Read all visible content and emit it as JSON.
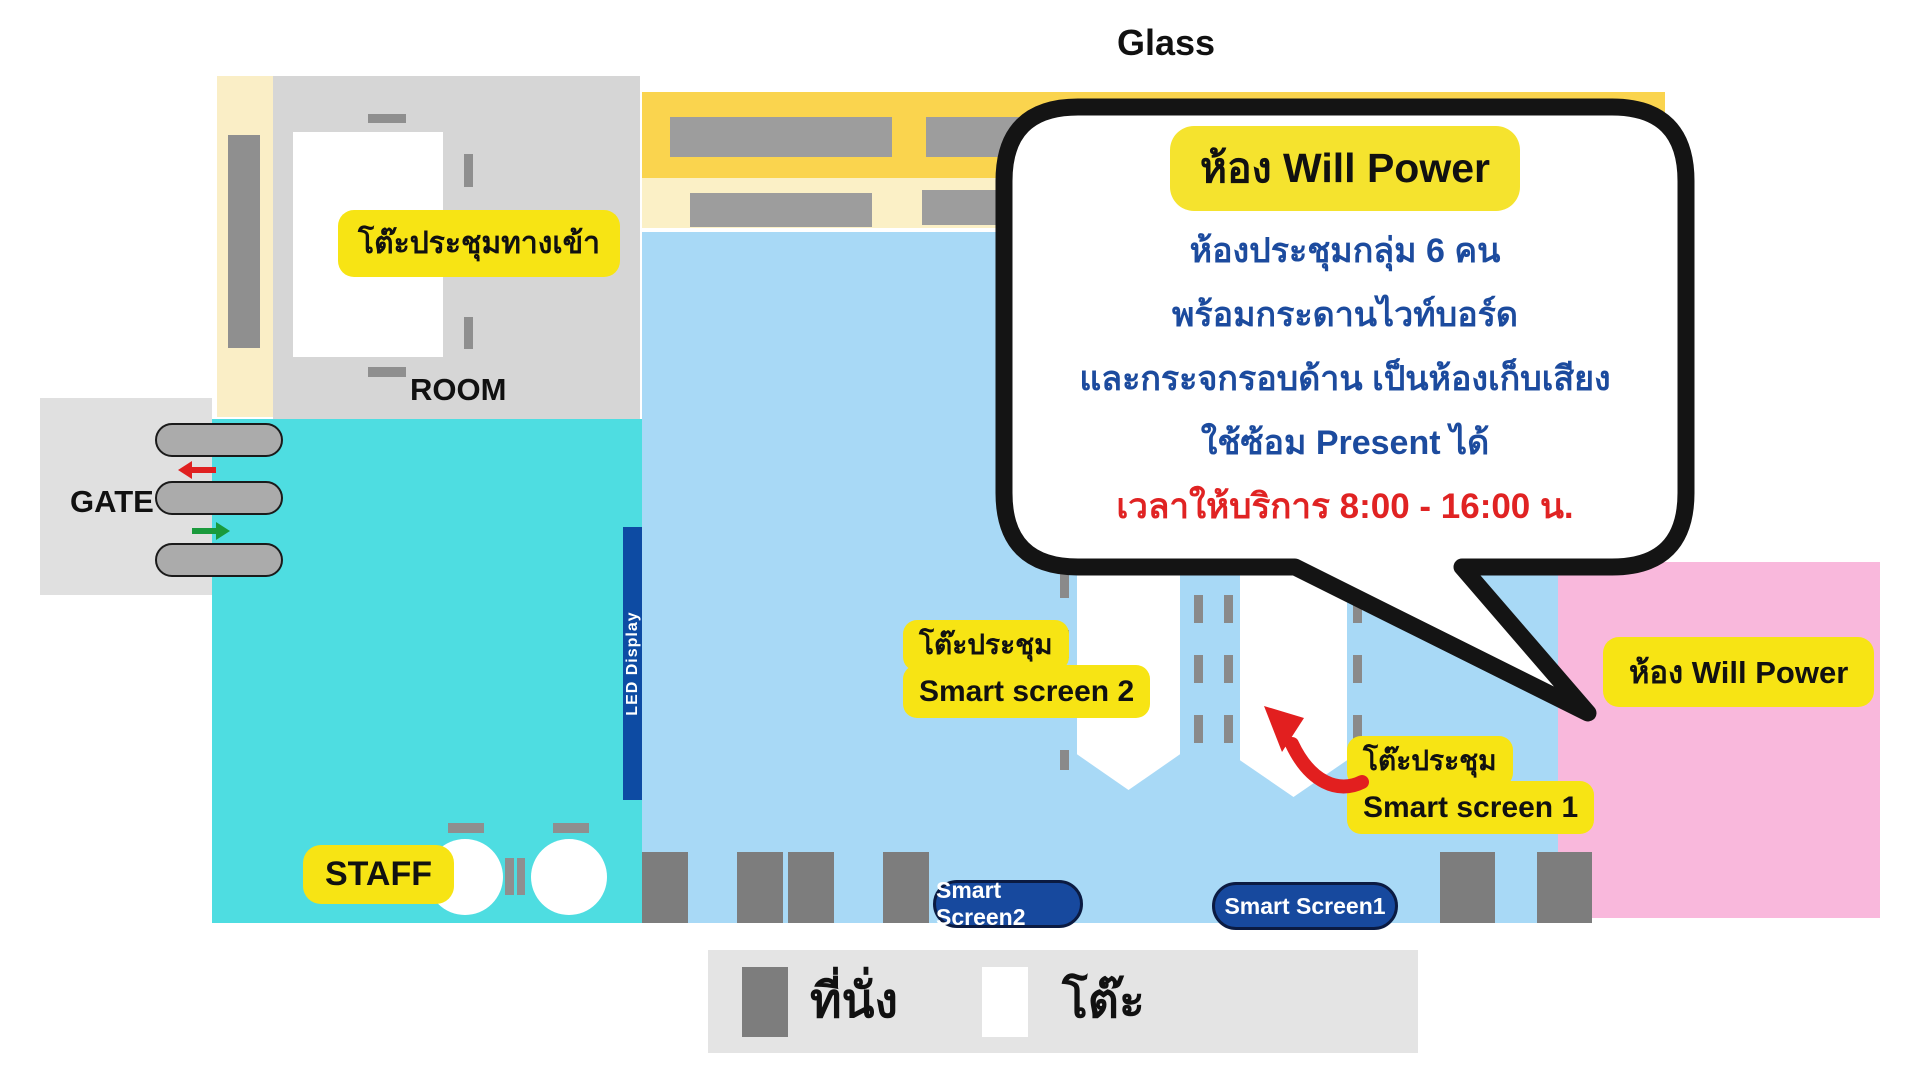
{
  "glass_label": "Glass",
  "entrance": {
    "table_label": "โต๊ะประชุมทางเข้า",
    "room_label": "ROOM"
  },
  "gate_label": "GATE",
  "staff_label": "STAFF",
  "led_display_label": "LED Display",
  "callout": {
    "title": "ห้อง Will Power",
    "lines": [
      "ห้องประชุมกลุ่ม 6 คน",
      "พร้อมกระดานไวท์บอร์ด",
      "และกระจกรอบด้าน เป็นห้องเก็บเสียง",
      "ใช้ซ้อม Present ได้"
    ],
    "service_time_line": "เวลาให้บริการ 8:00 - 16:00 น."
  },
  "zone_labels": {
    "smart_screen_2_line1": "โต๊ะประชุม",
    "smart_screen_2_line2": "Smart screen 2",
    "smart_screen_1_line1": "โต๊ะประชุม",
    "smart_screen_1_line2": "Smart screen 1",
    "will_power_room": "ห้อง Will Power"
  },
  "screen_pills": {
    "screen2": "Smart Screen2",
    "screen1": "Smart Screen1"
  },
  "legend": {
    "seat": "ที่นั่ง",
    "table": "โต๊ะ"
  },
  "colors": {
    "teal_zone": "#4edde1",
    "blue_zone": "#a8d9f6",
    "pink_zone": "#f9b8dc",
    "yellow_band": "#fad44e",
    "cream_band": "#fbf0c6",
    "label_yellow": "#f7e414",
    "pill_blue": "#17499e",
    "led_blue": "#0d4ba3",
    "callout_text_blue": "#1c4b9e",
    "callout_text_red": "#e02323",
    "gate_arrow_red": "#e02020",
    "gate_arrow_green": "#1a9a3c"
  }
}
